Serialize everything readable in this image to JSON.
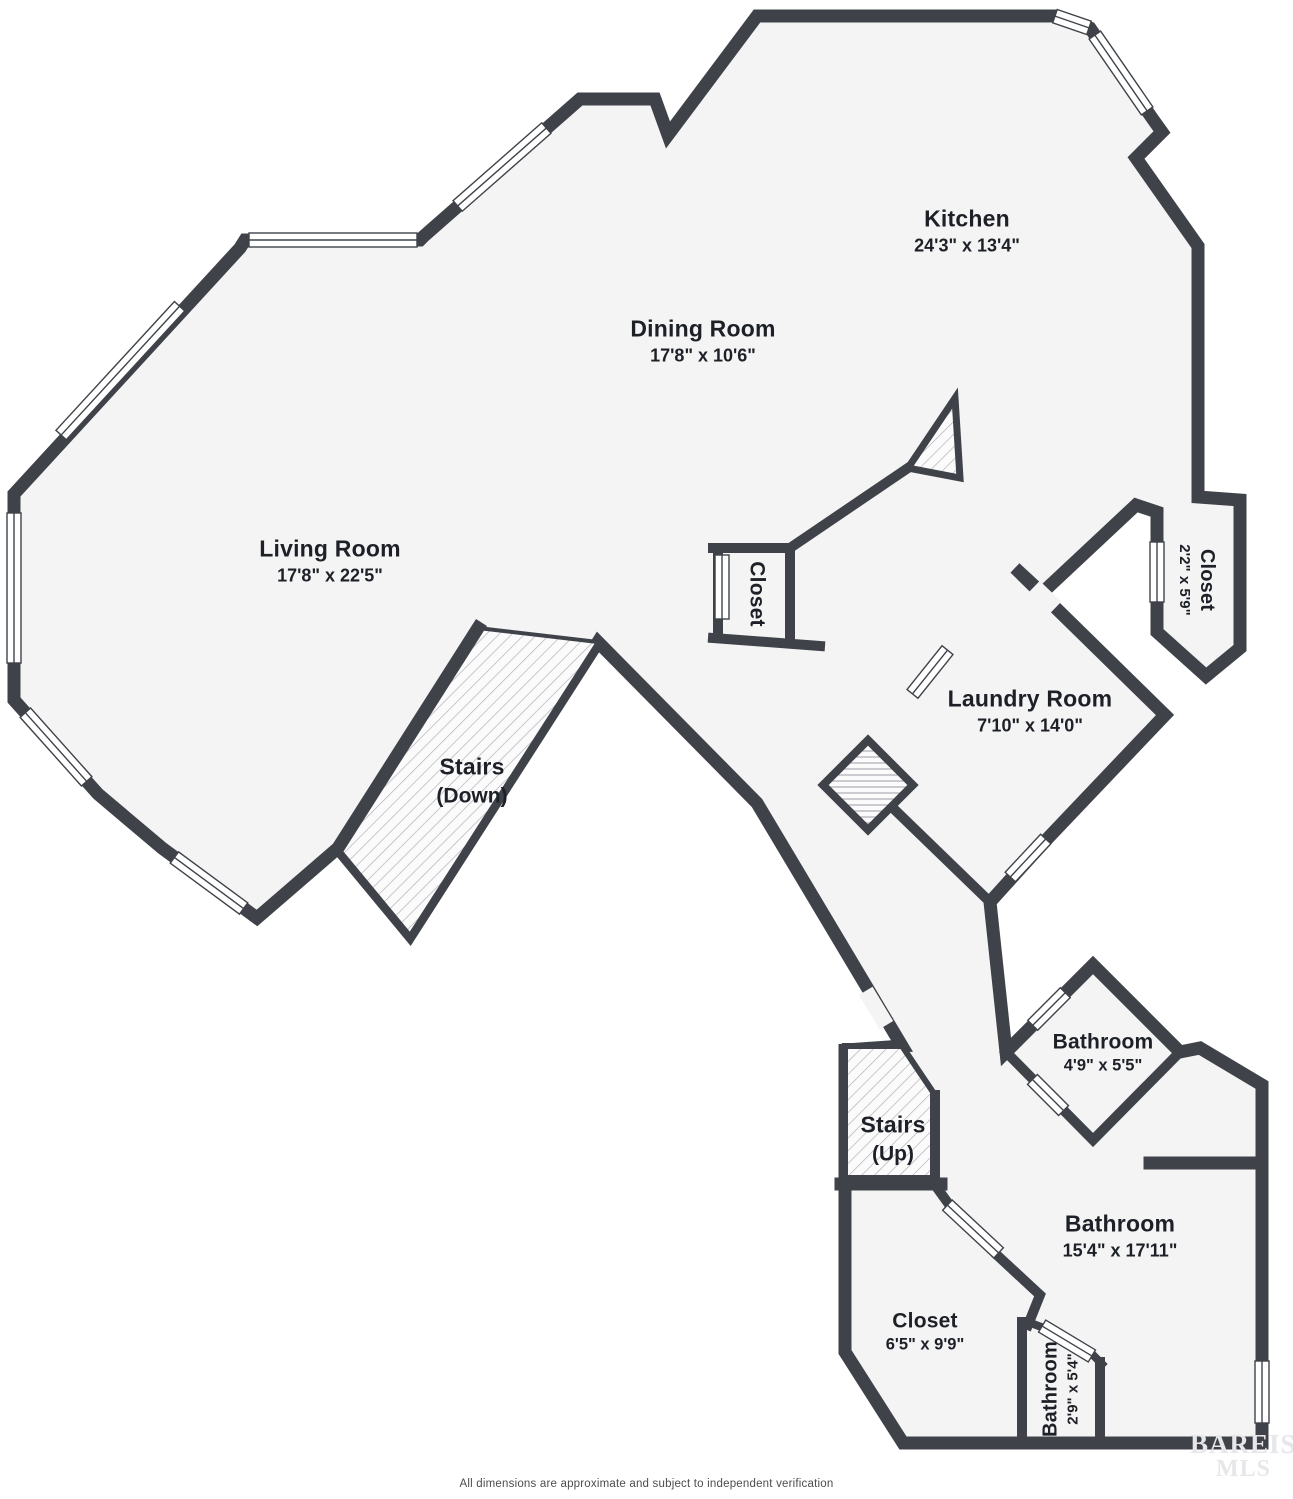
{
  "palette": {
    "wall": "#3f4349",
    "floor": "#f4f4f5",
    "hatch_line": "#aeaeb4",
    "hatch_bg": "#fbfbfc",
    "window_fill": "#ffffff",
    "text": "#1d2127",
    "watermark": "#e7e7ea",
    "disclaimer_text": "#4d4d4d"
  },
  "rooms": [
    {
      "name": "Kitchen",
      "dims": "24'3\" x 13'4\""
    },
    {
      "name": "Dining Room",
      "dims": "17'8\" x 10'6\""
    },
    {
      "name": "Living Room",
      "dims": "17'8\" x 22'5\""
    },
    {
      "name": "Closet",
      "dims": ""
    },
    {
      "name": "Closet",
      "dims": "2'2\" x 5'9\""
    },
    {
      "name": "Laundry Room",
      "dims": "7'10\" x 14'0\""
    },
    {
      "name": "Stairs",
      "dims": "(Down)"
    },
    {
      "name": "Bathroom",
      "dims": "4'9\" x 5'5\""
    },
    {
      "name": "Stairs",
      "dims": "(Up)"
    },
    {
      "name": "Bathroom",
      "dims": "15'4\" x 17'11\""
    },
    {
      "name": "Closet",
      "dims": "6'5\" x 9'9\""
    },
    {
      "name": "Bathroom",
      "dims": "2'9\" x 5'4\""
    }
  ],
  "footer": {
    "disclaimer": "All dimensions are approximate and subject to independent verification"
  },
  "watermark": {
    "line1": "BAREIS",
    "reg": "®",
    "line2": "MLS"
  }
}
